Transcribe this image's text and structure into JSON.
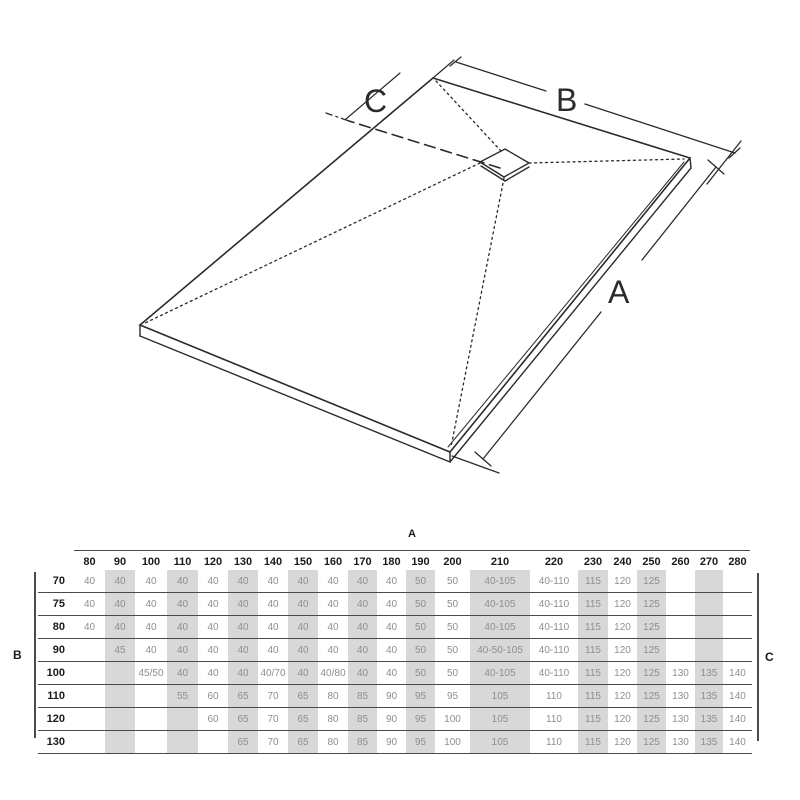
{
  "diagram": {
    "label_a": "A",
    "label_b": "B",
    "label_c": "C"
  },
  "table": {
    "axis_top": "A",
    "axis_left": "B",
    "axis_right": "C",
    "columns": [
      "80",
      "90",
      "100",
      "110",
      "120",
      "130",
      "140",
      "150",
      "160",
      "170",
      "180",
      "190",
      "200",
      "210",
      "220",
      "230",
      "240",
      "250",
      "260",
      "270",
      "280"
    ],
    "shaded_columns": [
      "90",
      "110",
      "130",
      "150",
      "170",
      "190",
      "210",
      "230",
      "250",
      "270"
    ],
    "rows": [
      {
        "label": "70",
        "cells": [
          "40",
          "40",
          "40",
          "40",
          "40",
          "40",
          "40",
          "40",
          "40",
          "40",
          "40",
          "50",
          "50",
          "40-105",
          "40-110",
          "115",
          "120",
          "125",
          "",
          "",
          ""
        ]
      },
      {
        "label": "75",
        "cells": [
          "40",
          "40",
          "40",
          "40",
          "40",
          "40",
          "40",
          "40",
          "40",
          "40",
          "40",
          "50",
          "50",
          "40-105",
          "40-110",
          "115",
          "120",
          "125",
          "",
          "",
          ""
        ]
      },
      {
        "label": "80",
        "cells": [
          "40",
          "40",
          "40",
          "40",
          "40",
          "40",
          "40",
          "40",
          "40",
          "40",
          "40",
          "50",
          "50",
          "40-105",
          "40-110",
          "115",
          "120",
          "125",
          "",
          "",
          ""
        ]
      },
      {
        "label": "90",
        "cells": [
          "",
          "45",
          "40",
          "40",
          "40",
          "40",
          "40",
          "40",
          "40",
          "40",
          "40",
          "50",
          "50",
          "40-50-105",
          "40-110",
          "115",
          "120",
          "125",
          "",
          "",
          ""
        ]
      },
      {
        "label": "100",
        "cells": [
          "",
          "",
          "45/50",
          "40",
          "40",
          "40",
          "40/70",
          "40",
          "40/80",
          "40",
          "40",
          "50",
          "50",
          "40-105",
          "40-110",
          "115",
          "120",
          "125",
          "130",
          "135",
          "140"
        ]
      },
      {
        "label": "110",
        "cells": [
          "",
          "",
          "",
          "55",
          "60",
          "65",
          "70",
          "65",
          "80",
          "85",
          "90",
          "95",
          "95",
          "105",
          "110",
          "115",
          "120",
          "125",
          "130",
          "135",
          "140"
        ]
      },
      {
        "label": "120",
        "cells": [
          "",
          "",
          "",
          "",
          "60",
          "65",
          "70",
          "65",
          "80",
          "85",
          "90",
          "95",
          "100",
          "105",
          "110",
          "115",
          "120",
          "125",
          "130",
          "135",
          "140"
        ]
      },
      {
        "label": "130",
        "cells": [
          "",
          "",
          "",
          "",
          "",
          "65",
          "70",
          "65",
          "80",
          "85",
          "90",
          "95",
          "100",
          "105",
          "110",
          "115",
          "120",
          "125",
          "130",
          "135",
          "140"
        ]
      }
    ],
    "colors": {
      "shade": "#d8d8d8",
      "value_text": "#8e8e8e",
      "header_text": "#1a1a1a",
      "line": "#4a4a4a",
      "diagram_line": "#2b2b2b"
    }
  }
}
